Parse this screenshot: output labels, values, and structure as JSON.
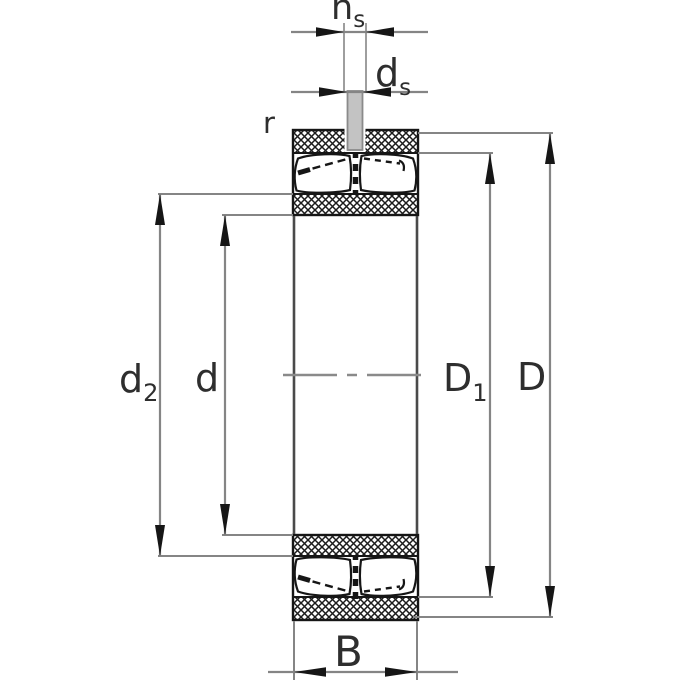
{
  "title": "Spherical roller bearing cross-section dimension drawing",
  "drawing": {
    "labels": {
      "ns": {
        "base": "n",
        "sub": "s"
      },
      "ds": {
        "base": "d",
        "sub": "s"
      },
      "r": {
        "base": "r",
        "sub": ""
      },
      "d2": {
        "base": "d",
        "sub": "2"
      },
      "d": {
        "base": "d",
        "sub": ""
      },
      "D1": {
        "base": "D",
        "sub": "1"
      },
      "D": {
        "base": "D",
        "sub": ""
      },
      "B": {
        "base": "B",
        "sub": ""
      }
    },
    "colors": {
      "background": "#ffffff",
      "ink": "#161616",
      "dimension_gray": "#858585",
      "label_color": "#2e2e2e",
      "lube_hole_gray": "#c3c3c3",
      "bore_edge_gray": "#4a4a4a"
    }
  }
}
